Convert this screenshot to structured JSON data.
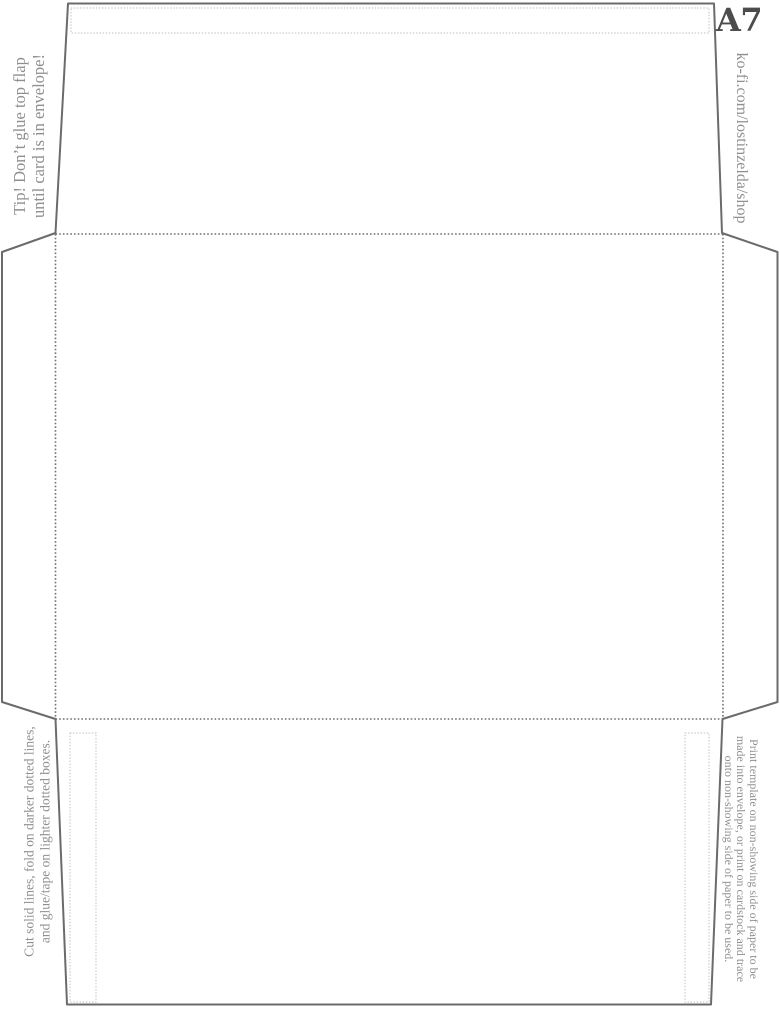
{
  "page": {
    "format_label": "A7"
  },
  "annotations": {
    "tip": {
      "line1": "Tip! Don’t glue top flap",
      "line2": "until card is in envelope!"
    },
    "shop_url": "ko-fi.com/lostinzelda/shop",
    "cutting": {
      "line1": "Cut solid lines, fold on darker dotted lines,",
      "line2": "and glue/tape on lighter dotted boxes."
    },
    "printing": {
      "line1": "Print template on non-showing side of paper to be",
      "line2": "made into envelope, or print on cardstock and trace",
      "line3": "onto non-showing side of paper to be used."
    }
  },
  "colors": {
    "cut_line": "#6b6b6b",
    "fold_dots": "#6f6f6f",
    "glue_box": "#c9c9c9",
    "annotation_text": "#8f8f8f",
    "format_text": "#4c4c4c",
    "background": "#ffffff"
  }
}
